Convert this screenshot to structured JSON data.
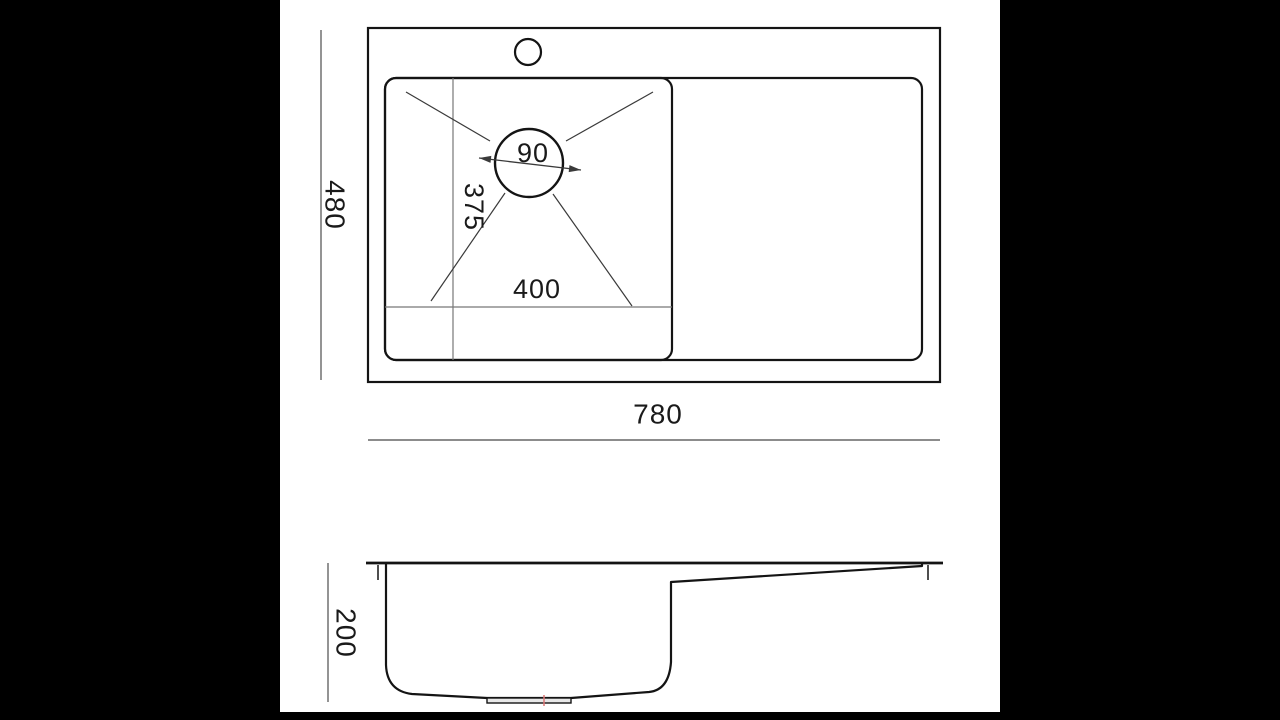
{
  "page": {
    "background": "#ffffff",
    "letterbox_color": "#000000"
  },
  "drawing": {
    "type": "sink-dimension-drawing",
    "top_view": {
      "overall_width": "780",
      "overall_depth": "480",
      "bowl_width": "400",
      "bowl_depth": "375",
      "drain_diameter": "90"
    },
    "side_view": {
      "height": "200"
    },
    "colors": {
      "outline": "#141414",
      "dim_line": "#666666",
      "thin_line": "#777777",
      "diagonal_line": "#3a3a3a",
      "drain_mark_red": "#dd7777",
      "fitting_fill": "#e8e8e8"
    }
  }
}
